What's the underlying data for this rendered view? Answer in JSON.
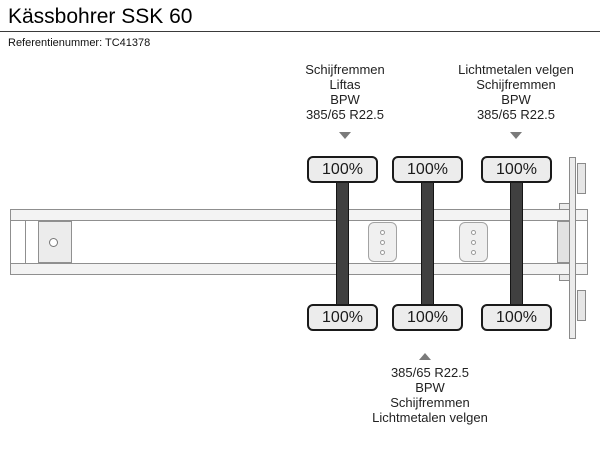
{
  "header": {
    "title": "Kässbohrer SSK 60",
    "reference": "Referentienummer: TC41378"
  },
  "diagram": {
    "front_axle_annotation": {
      "lines": [
        "Schijfremmen",
        "Liftas",
        "BPW",
        "385/65 R22.5"
      ]
    },
    "rear_axle_annotation": {
      "lines": [
        "Lichtmetalen velgen",
        "Schijfremmen",
        "BPW",
        "385/65 R22.5"
      ]
    },
    "middle_axle_annotation": {
      "lines": [
        "385/65 R22.5",
        "BPW",
        "Schijfremmen",
        "Lichtmetalen velgen"
      ]
    },
    "tires": {
      "axle1_left": "100%",
      "axle2_left": "100%",
      "axle3_left": "100%",
      "axle1_right": "100%",
      "axle2_right": "100%",
      "axle3_right": "100%"
    },
    "colors": {
      "axle_bar": "#404040",
      "tire_fill": "#ececec",
      "tire_border": "#1a1a1a",
      "frame_stroke": "#8f8f8f",
      "frame_fill": "#f3f3f3",
      "arrow": "#7a7a7a",
      "text": "#1c1c1c"
    }
  }
}
